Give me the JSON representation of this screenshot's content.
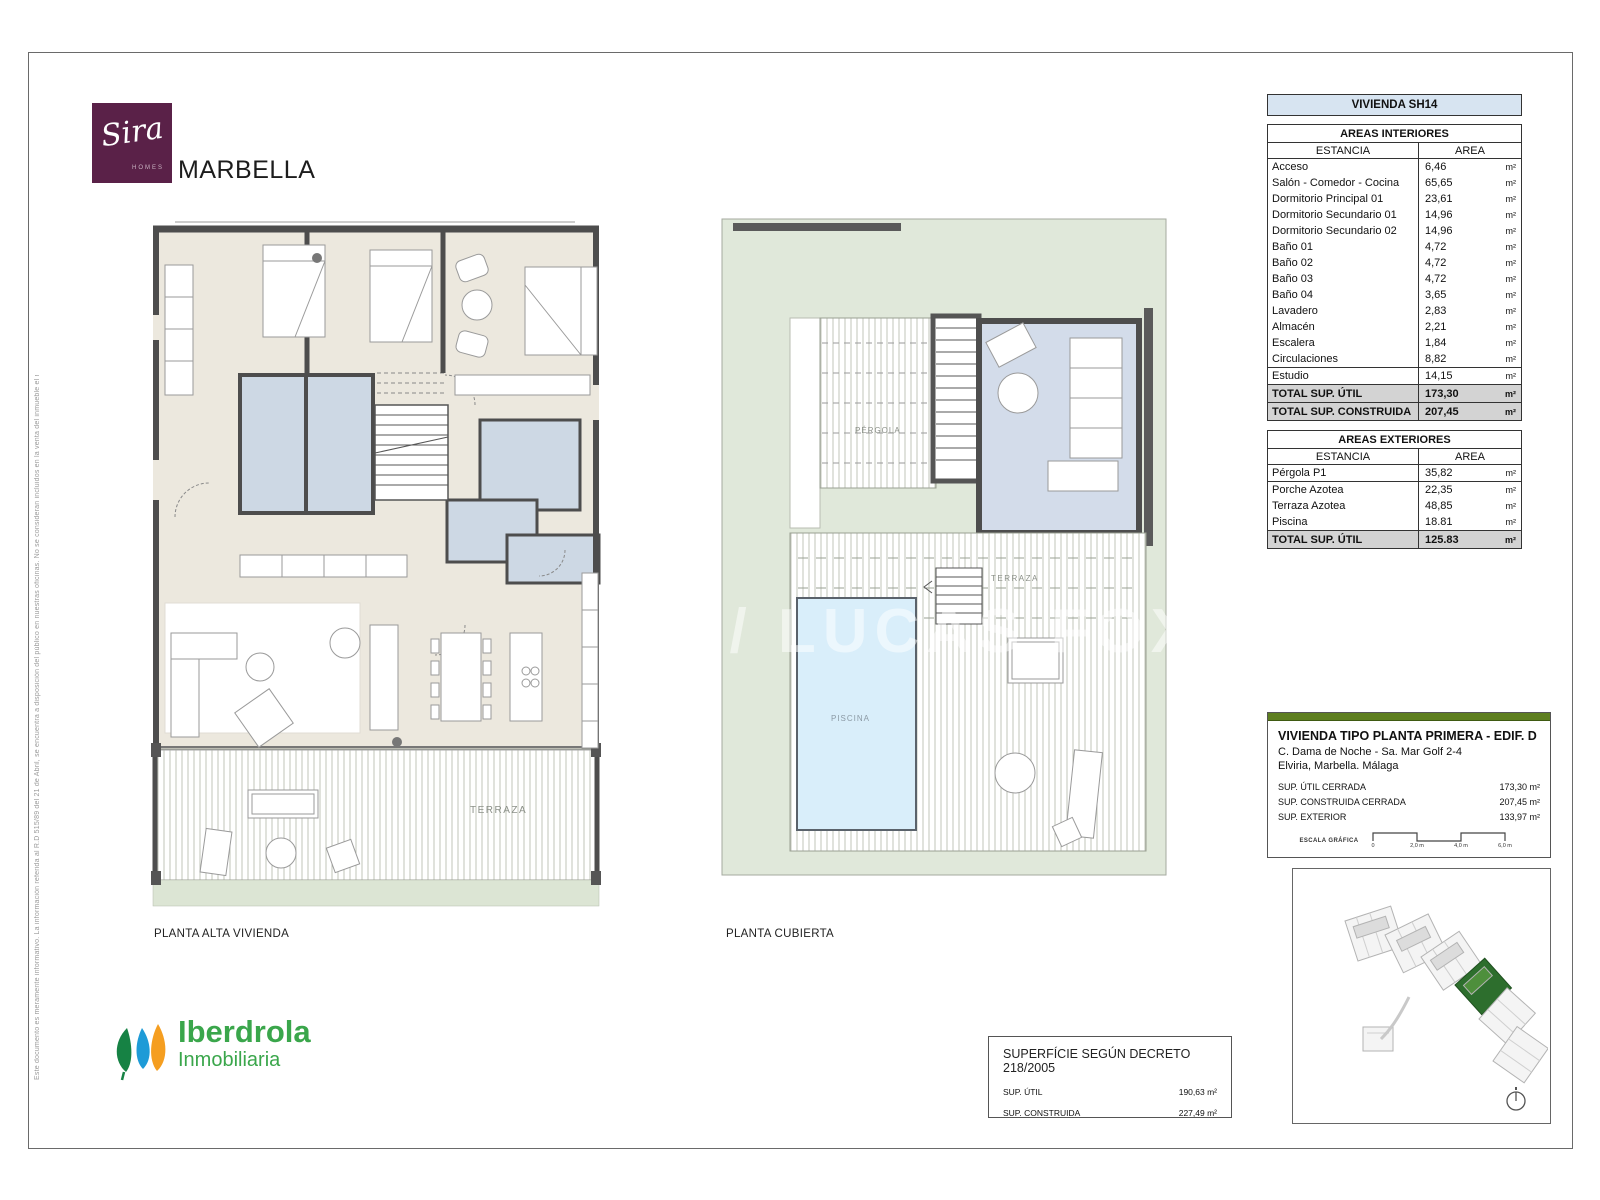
{
  "brand": {
    "logo_script": "Sira",
    "logo_sub": "HOMES",
    "city": "MARBELLA"
  },
  "disclaimer": "Este documento es meramente informativo. La información referida al R.D 515/89 del 21 de Abril, se encuentra a disposición del público en nuestras oficinas. No se consideran incluidos en la venta del inmueble el mobiliario.",
  "unit_header": "VIVIENDA SH14",
  "tables": {
    "interiores": {
      "title": "AREAS INTERIORES",
      "col_estancia": "ESTANCIA",
      "col_area": "AREA",
      "rows": [
        [
          "Acceso",
          "6,46",
          "m²"
        ],
        [
          "Salón - Comedor - Cocina",
          "65,65",
          "m²"
        ],
        [
          "Dormitorio Principal 01",
          "23,61",
          "m²"
        ],
        [
          "Dormitorio Secundario 01",
          "14,96",
          "m²"
        ],
        [
          "Dormitorio Secundario 02",
          "14,96",
          "m²"
        ],
        [
          "Baño 01",
          "4,72",
          "m²"
        ],
        [
          "Baño 02",
          "4,72",
          "m²"
        ],
        [
          "Baño 03",
          "4,72",
          "m²"
        ],
        [
          "Baño 04",
          "3,65",
          "m²"
        ],
        [
          "Lavadero",
          "2,83",
          "m²"
        ],
        [
          "Almacén",
          "2,21",
          "m²"
        ],
        [
          "Escalera",
          "1,84",
          "m²"
        ],
        [
          "Circulaciones",
          "8,82",
          "m²"
        ],
        [
          "Estudio",
          "14,15",
          "m²"
        ]
      ],
      "totals": [
        [
          "TOTAL SUP. ÚTIL",
          "173,30",
          "m²"
        ],
        [
          "TOTAL SUP. CONSTRUIDA",
          "207,45",
          "m²"
        ]
      ]
    },
    "exteriores": {
      "title": "AREAS EXTERIORES",
      "col_estancia": "ESTANCIA",
      "col_area": "AREA",
      "rows": [
        [
          "Pérgola P1",
          "35,82",
          "m²"
        ],
        [
          "Porche Azotea",
          "22,35",
          "m²"
        ],
        [
          "Terraza Azotea",
          "48,85",
          "m²"
        ],
        [
          "Piscina",
          "18.81",
          "m²"
        ]
      ],
      "totals": [
        [
          "TOTAL SUP. ÚTIL",
          "125.83",
          "m²"
        ]
      ]
    }
  },
  "plans": {
    "left": {
      "caption": "PLANTA ALTA VIVIENDA",
      "terraza_label": "TERRAZA"
    },
    "right": {
      "caption": "PLANTA CUBIERTA",
      "pergola_label": "PÉRGOLA",
      "terraza_label": "TERRAZA",
      "piscina_label": "PISCINA"
    }
  },
  "info_box": {
    "title": "VIVIENDA TIPO PLANTA PRIMERA - EDIF. D",
    "address1": "C. Dama de Noche - Sa. Mar Golf 2-4",
    "address2": "Elviria, Marbella. Málaga",
    "rows": [
      [
        "SUP. ÚTIL CERRADA",
        "173,30 m²"
      ],
      [
        "SUP. CONSTRUIDA CERRADA",
        "207,45 m²"
      ],
      [
        "SUP. EXTERIOR",
        "133,97 m²"
      ]
    ],
    "scale_label": "ESCALA GRÁFICA",
    "scale_ticks": [
      "0",
      "2,0 m",
      "4,0 m",
      "6,0 m"
    ]
  },
  "decreto_box": {
    "title": "SUPERFÍCIE SEGÚN DECRETO 218/2005",
    "rows": [
      [
        "SUP. ÚTIL",
        "190,63 m²"
      ],
      [
        "SUP. CONSTRUIDA",
        "227,49 m²"
      ]
    ]
  },
  "footer_brand": {
    "name": "Iberdrola",
    "sub": "Inmobiliaria"
  },
  "watermark": "LS / LUCAS FOX",
  "colors": {
    "sira_purple": "#5a2148",
    "iberdrola_green": "#3aa64b",
    "info_bar_green": "#5e7f20",
    "header_blue": "#d7e4f1",
    "plan_cream": "#ece8de",
    "bath_blue": "#cdd8e4",
    "roof_green": "#e0e8da",
    "pool_blue": "#d9eefa",
    "total_gray": "#d3d3d3"
  }
}
